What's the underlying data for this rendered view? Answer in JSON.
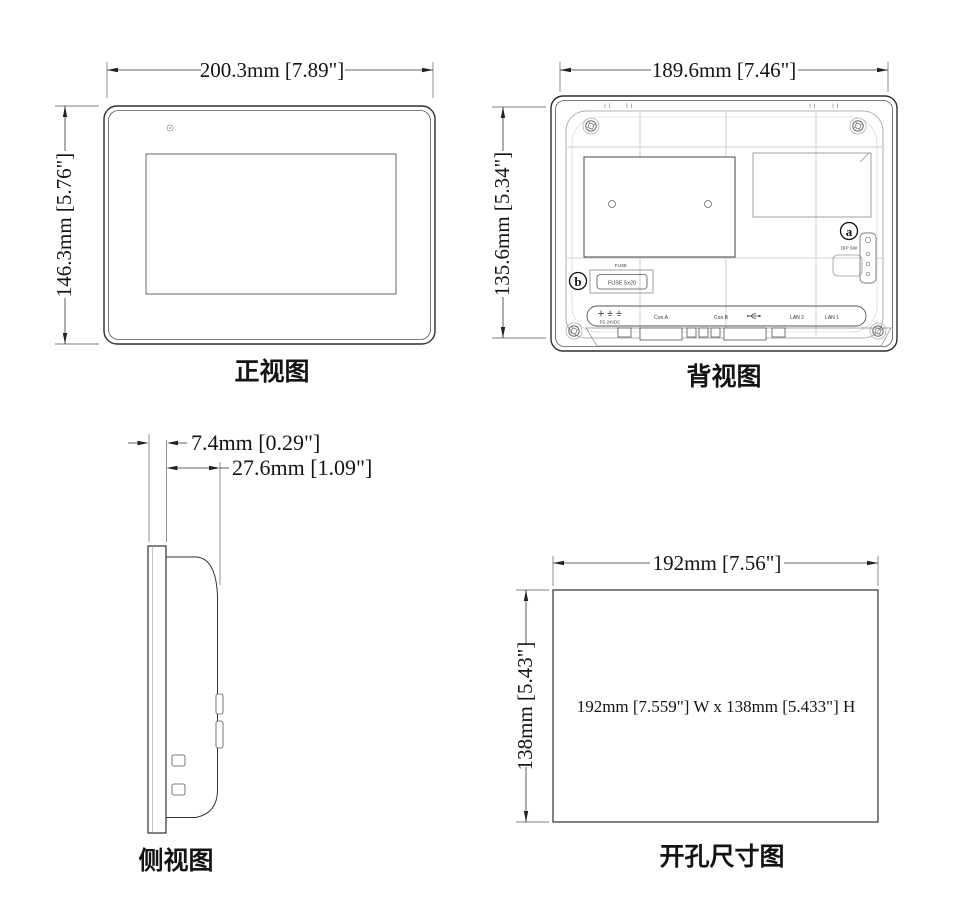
{
  "drawing": {
    "background_color": "#ffffff",
    "line_color": "#2e2e2e",
    "dim_text_color": "#141414",
    "views": {
      "front": {
        "label": "正视图",
        "width_dim": "200.3mm [7.89\"]",
        "height_dim": "146.3mm [5.76\"]",
        "led_icon": "led-indicator-icon"
      },
      "back": {
        "label": "背视图",
        "width_dim": "189.6mm [7.46\"]",
        "height_dim": "135.6mm [5.34\"]",
        "callout_a": {
          "letter": "a",
          "label": "DIP SW"
        },
        "callout_b": {
          "letter": "b"
        },
        "fuse": {
          "caption": "FUSE",
          "value": "FUSE 5x20"
        },
        "ports": {
          "power_terminal_icon": "plus-ground-ground-icon",
          "power_label": "FG  24VDC",
          "com_a": "Con.A",
          "com_b": "Con.B",
          "usb_icon": "usb-icon",
          "lan2": "LAN 2",
          "lan1": "LAN 1"
        },
        "screw_icon": "screw-icon",
        "dip_switch_icon": "dip-switch-icon"
      },
      "side": {
        "label": "侧视图",
        "bezel_depth_dim": "7.4mm [0.29\"]",
        "total_depth_dim": "27.6mm [1.09\"]"
      },
      "cutout": {
        "label": "开孔尺寸图",
        "width_dim": "192mm [7.56\"]",
        "height_dim": "138mm [5.43\"]",
        "center_note": "192mm [7.559\"] W x 138mm [5.433\"] H"
      }
    }
  }
}
